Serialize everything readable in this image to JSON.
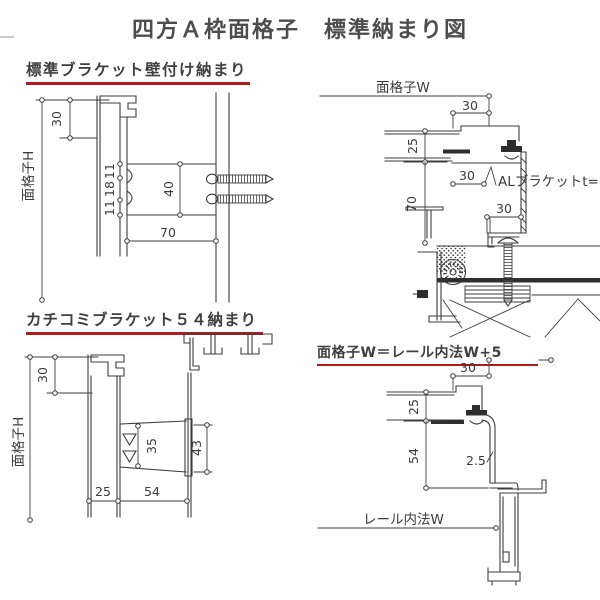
{
  "title": "四方Ａ枠面格子　標準納まり図",
  "colors": {
    "accent_red": "#b31a1e",
    "line": "#3d3d3d",
    "text": "#3f3f3f"
  },
  "sections": {
    "top_left": {
      "heading": "標準ブラケット壁付け納まり",
      "height_label": "面格子H",
      "dims": {
        "top": "30",
        "seg_a": "11",
        "seg_b": "18",
        "seg_c": "11",
        "bracket_h": "40",
        "depth": "70"
      }
    },
    "bottom_left": {
      "heading": "カチコミブラケット５４納まり",
      "height_label": "面格子H",
      "dims": {
        "top": "30",
        "notch": "35",
        "bracket_h": "43",
        "offset": "25",
        "depth": "54"
      }
    },
    "top_right": {
      "width_label": "面格子W",
      "bracket_label": "ALブラケットt=3",
      "dims": {
        "edge": "30",
        "face": "25",
        "inner": "30",
        "drop": "70",
        "foot": "30"
      }
    },
    "bottom_right": {
      "heading": "面格子W＝レール内法W+5",
      "rail_label": "レール内法W",
      "dims": {
        "edge": "30",
        "face": "25",
        "drop": "54",
        "plate_t": "2.5"
      }
    }
  }
}
